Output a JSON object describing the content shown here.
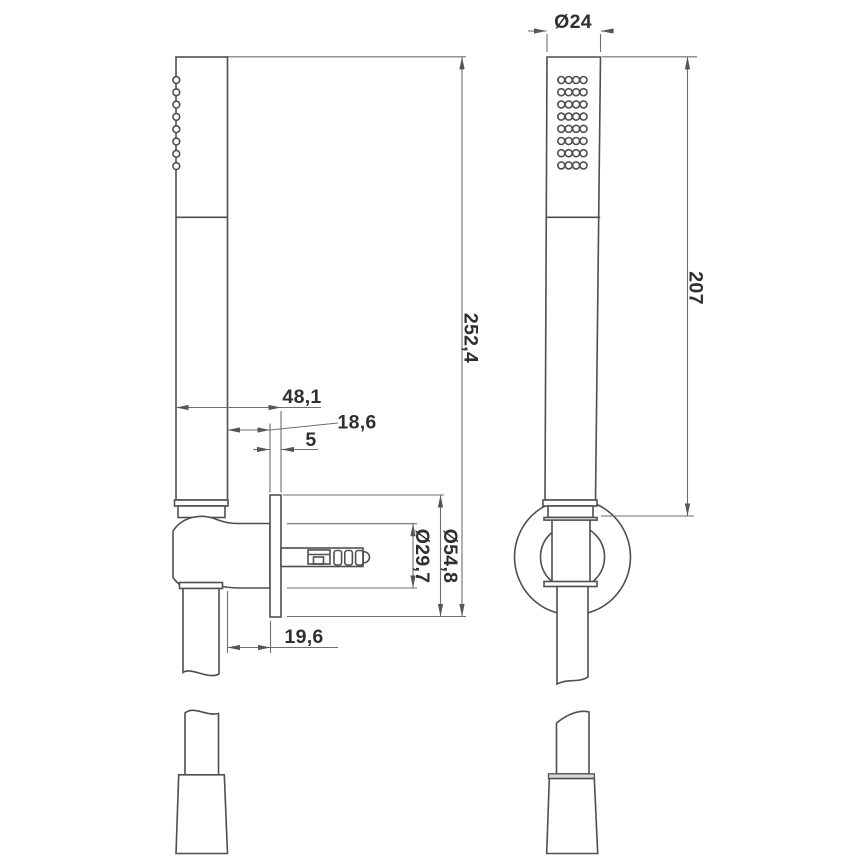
{
  "drawing": {
    "dimensions": {
      "head_diameter": "Ø24",
      "handset_length": "207",
      "overall_length": "252,4",
      "wall_to_front": "48,1",
      "handle_to_plate": "18,6",
      "plate_thickness": "5",
      "boss_diameter": "Ø29,7",
      "escutcheon_diameter": "Ø54,8",
      "hose_to_plate": "19,6"
    },
    "colors": {
      "background": "#ffffff",
      "object_line": "#4f4f4f",
      "dimension_line": "#6e6e6e",
      "text": "#2f2f2f",
      "flange_fill": "#d9d9d9"
    }
  }
}
